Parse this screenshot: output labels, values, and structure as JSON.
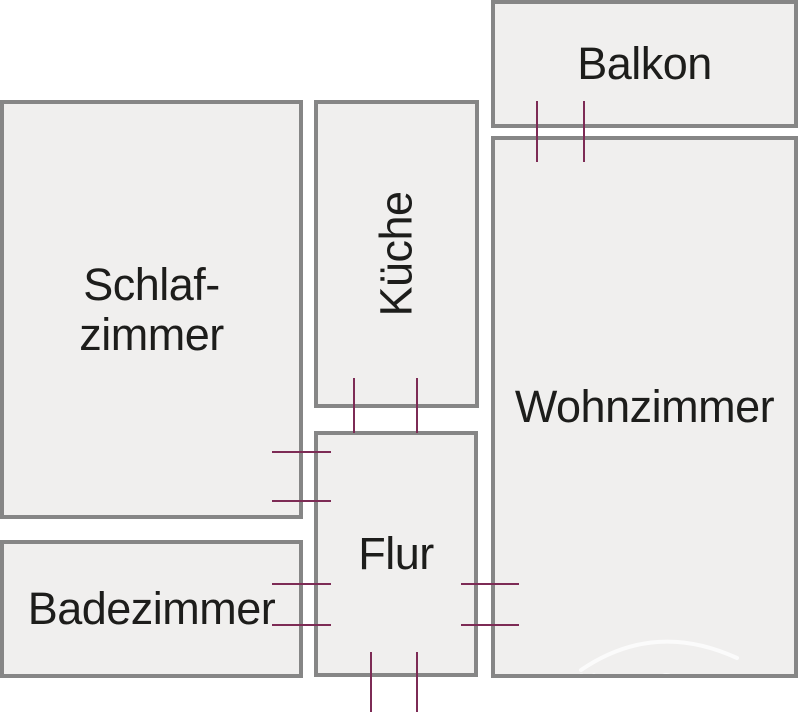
{
  "rooms": {
    "balkon": {
      "label": "Balkon"
    },
    "wohnzimmer": {
      "label": "Wohnzimmer"
    },
    "schlafzimmer": {
      "label_line1": "Schlaf-",
      "label_line2": "zimmer"
    },
    "kueche": {
      "label": "Küche"
    },
    "flur": {
      "label": "Flur"
    },
    "badezimmer": {
      "label": "Badezimmer"
    }
  },
  "watermark": {
    "text": "HomeCompany"
  },
  "colors": {
    "background": "#ffffff",
    "room_fill": "#f0efee",
    "wall": "#868686",
    "door_marker": "#7d2b55",
    "label_text": "#1d1d1b"
  }
}
